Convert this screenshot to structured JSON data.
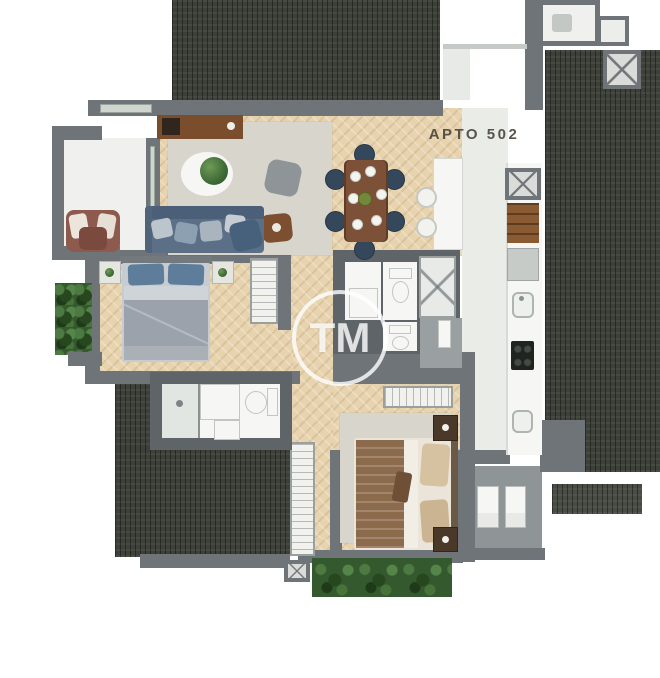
{
  "plan": {
    "unit_label": "APTO 502",
    "watermark_text": "TM"
  },
  "colors": {
    "roof": "#3d4039",
    "wall": "#6e7478",
    "walldark": "#5e6468",
    "wood": "#e7d3ae",
    "whitefloor": "#f0f1ee",
    "kitchenfloor": "#eaece8",
    "rug": "#d8d5cc",
    "sofa": "#5b7086",
    "sofadark": "#4b5f78",
    "armchair": "#8f5a4e",
    "tablebrown": "#7d5137",
    "chairblue": "#35475a",
    "pouf": "#8f9499",
    "sidetable": "#7c4f31",
    "green": "#3a6132",
    "bedblanket": "#9ba2ab",
    "bedpillow": "#5e7d9a",
    "bedsheet": "#cfd4d9",
    "msblanket": "#8c6a4c",
    "mssheet": "#f2ede5",
    "nightstand": "#4a3929",
    "cabinet": "#8a5a32",
    "cooktop": "#20241f",
    "fixture": "#f6f7f4",
    "terrace": "#8f9496",
    "entry": "#9aa0a2",
    "label": "rgba(72,68,60,0.9)",
    "watermark": "rgba(255,255,255,0.8)"
  }
}
